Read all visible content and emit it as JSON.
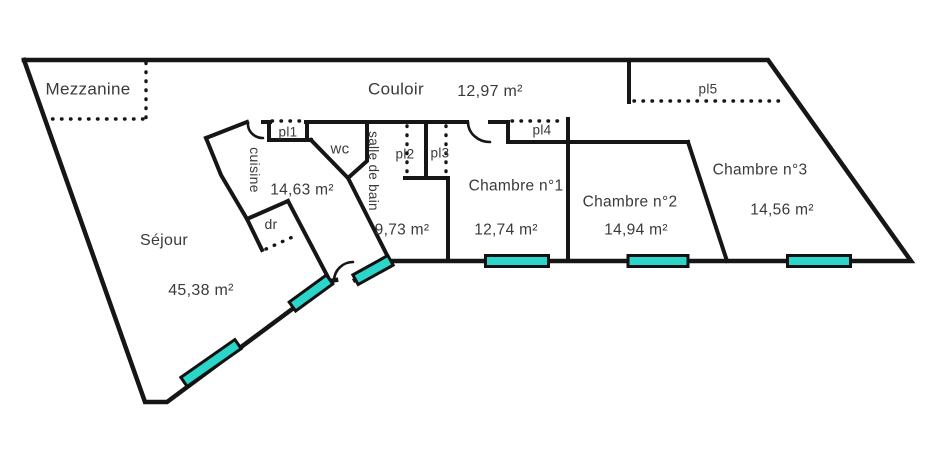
{
  "plan_title": "Floor plan",
  "colors": {
    "background": "#ffffff",
    "wall": "#161616",
    "window_fill": "#2bd5c9",
    "window_border": "#111111",
    "text": "#3a3a3a"
  },
  "rooms": [
    {
      "id": "mezzanine",
      "name": "Mezzanine",
      "area": null
    },
    {
      "id": "couloir",
      "name": "Couloir",
      "area": "12,97 m²"
    },
    {
      "id": "cuisine",
      "name": "cuisine",
      "area": "14,63 m²"
    },
    {
      "id": "wc",
      "name": "wc",
      "area": null
    },
    {
      "id": "salle-de-bain",
      "name": "salle de bain",
      "area": "9,73 m²"
    },
    {
      "id": "dressing",
      "name": "dr",
      "area": null
    },
    {
      "id": "sejour",
      "name": "Séjour",
      "area": "45,38 m²"
    },
    {
      "id": "chambre-1",
      "name": "Chambre n°1",
      "area": "12,74 m²"
    },
    {
      "id": "chambre-2",
      "name": "Chambre n°2",
      "area": "14,94 m²"
    },
    {
      "id": "chambre-3",
      "name": "Chambre n°3",
      "area": "14,56 m²"
    },
    {
      "id": "pl1",
      "name": "pl1",
      "area": null
    },
    {
      "id": "pl2",
      "name": "pl2",
      "area": null
    },
    {
      "id": "pl3",
      "name": "pl3",
      "area": null
    },
    {
      "id": "pl4",
      "name": "pl4",
      "area": null
    },
    {
      "id": "pl5",
      "name": "pl5",
      "area": null
    }
  ],
  "labels": [
    {
      "id": "mezzanine-name",
      "text": "Mezzanine",
      "x": 88,
      "y": 89,
      "size": 17,
      "rotate": false
    },
    {
      "id": "couloir-name",
      "text": "Couloir",
      "x": 396,
      "y": 89,
      "size": 17,
      "rotate": false
    },
    {
      "id": "couloir-area",
      "text": "12,97 m²",
      "x": 490,
      "y": 92,
      "size": 16,
      "rotate": false
    },
    {
      "id": "pl1-name",
      "text": "pl1",
      "x": 288,
      "y": 132,
      "size": 13.5,
      "rotate": false
    },
    {
      "id": "pl2-name",
      "text": "pl2",
      "x": 405,
      "y": 154,
      "size": 13.5,
      "rotate": false
    },
    {
      "id": "pl3-name",
      "text": "pl3",
      "x": 440,
      "y": 153,
      "size": 13.5,
      "rotate": false
    },
    {
      "id": "pl4-name",
      "text": "pl4",
      "x": 542,
      "y": 130,
      "size": 13.5,
      "rotate": false
    },
    {
      "id": "pl5-name",
      "text": "pl5",
      "x": 708,
      "y": 89,
      "size": 13.5,
      "rotate": false
    },
    {
      "id": "cuisine-name",
      "text": "cuisine",
      "x": 255,
      "y": 170,
      "size": 14,
      "rotate": true
    },
    {
      "id": "cuisine-area",
      "text": "14,63 m²",
      "x": 302,
      "y": 190,
      "size": 15.5,
      "rotate": false
    },
    {
      "id": "wc-name",
      "text": "wc",
      "x": 340,
      "y": 149,
      "size": 15,
      "rotate": false
    },
    {
      "id": "sdb-name",
      "text": "salle de bain",
      "x": 373,
      "y": 171,
      "size": 13.5,
      "rotate": true
    },
    {
      "id": "sdb-area",
      "text": "9,73 m²",
      "x": 402,
      "y": 230,
      "size": 15.5,
      "rotate": false
    },
    {
      "id": "dr-name",
      "text": "dr",
      "x": 271,
      "y": 224,
      "size": 14,
      "rotate": false
    },
    {
      "id": "sejour-name",
      "text": "Séjour",
      "x": 164,
      "y": 241,
      "size": 16,
      "rotate": false
    },
    {
      "id": "sejour-area",
      "text": "45,38 m²",
      "x": 201,
      "y": 291,
      "size": 16,
      "rotate": false
    },
    {
      "id": "chambre1-name",
      "text": "Chambre n°1",
      "x": 516,
      "y": 186,
      "size": 15.5,
      "rotate": false
    },
    {
      "id": "chambre1-area",
      "text": "12,74 m²",
      "x": 506,
      "y": 230,
      "size": 15.5,
      "rotate": false
    },
    {
      "id": "chambre2-name",
      "text": "Chambre n°2",
      "x": 630,
      "y": 202,
      "size": 15.5,
      "rotate": false
    },
    {
      "id": "chambre2-area",
      "text": "14,94 m²",
      "x": 636,
      "y": 230,
      "size": 15.5,
      "rotate": false
    },
    {
      "id": "chambre3-name",
      "text": "Chambre n°3",
      "x": 760,
      "y": 170,
      "size": 15.5,
      "rotate": false
    },
    {
      "id": "chambre3-area",
      "text": "14,56 m²",
      "x": 782,
      "y": 210,
      "size": 15.5,
      "rotate": false
    }
  ],
  "windows": [
    {
      "id": "window-sejour-lower",
      "cx": 211,
      "cy": 363,
      "len": 66,
      "angle": -35
    },
    {
      "id": "window-sejour-upper",
      "cx": 311,
      "cy": 293,
      "len": 46,
      "angle": -36
    },
    {
      "id": "window-entry",
      "cx": 373,
      "cy": 270,
      "len": 40,
      "angle": -29
    },
    {
      "id": "window-chambre-1",
      "cx": 517,
      "cy": 261,
      "len": 63,
      "angle": 0
    },
    {
      "id": "window-chambre-2",
      "cx": 658,
      "cy": 261,
      "len": 60,
      "angle": 0
    },
    {
      "id": "window-chambre-3",
      "cx": 819,
      "cy": 261,
      "len": 63,
      "angle": 0
    }
  ]
}
